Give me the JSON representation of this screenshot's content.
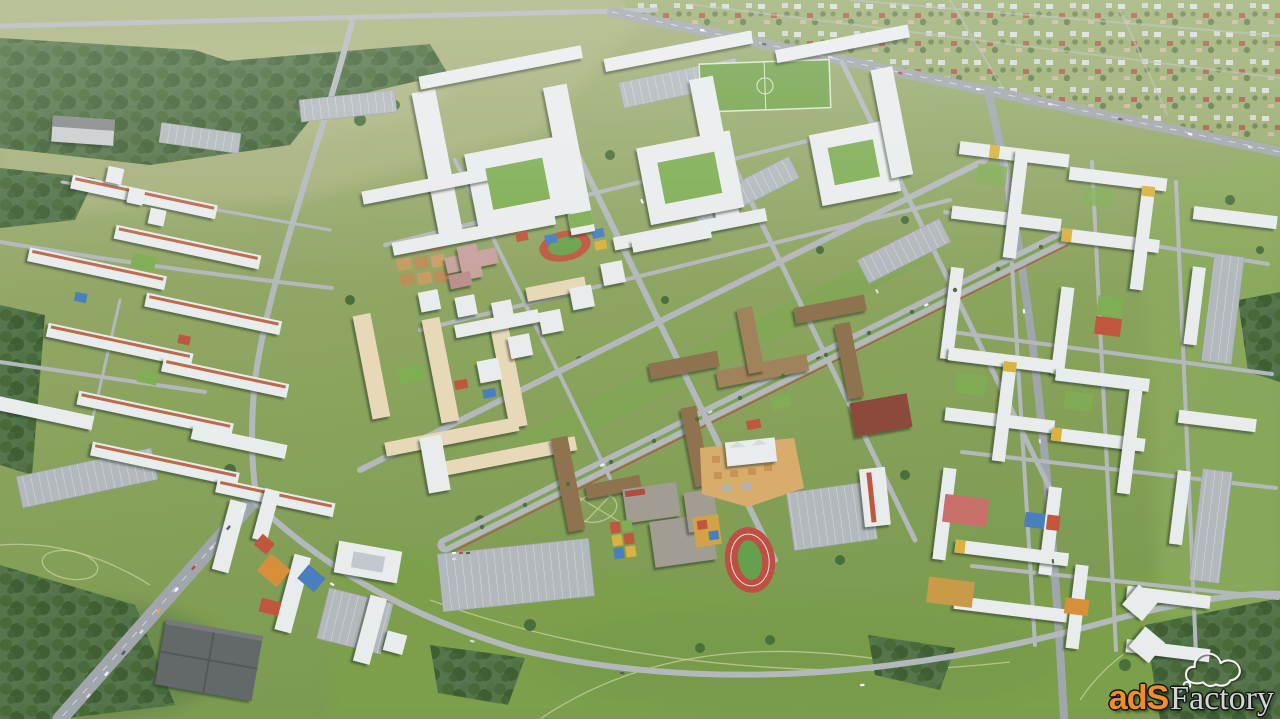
{
  "watermark": {
    "brand_prefix": "adS",
    "brand_suffix": "Factory",
    "icon": "cloud",
    "prefix_color": "#ef8d2a",
    "suffix_color": "#d4d5d7",
    "outline_color": "#141414"
  },
  "scene": {
    "subject": "aerial 3d render of a residential district masterplan",
    "palette": {
      "field_light": "#a6b07c",
      "field_bright": "#7da04b",
      "forest": "#486a39",
      "road": "#b3b8bc",
      "highway": "#a0a6ab",
      "building_white": "#e9eced",
      "building_beige": "#e7d8b8",
      "building_bronze": "#8f7350",
      "school_gray": "#a19d93",
      "school_roof_pink": "#c9a2a0",
      "court_red": "#c0563e",
      "court_blue": "#4a7fbe",
      "court_orange": "#d78f3c",
      "court_yellow": "#d9b23f",
      "pitch_green": "#67a04c",
      "sand": "#d8ad6c",
      "mall_dark": "#64686b"
    }
  }
}
